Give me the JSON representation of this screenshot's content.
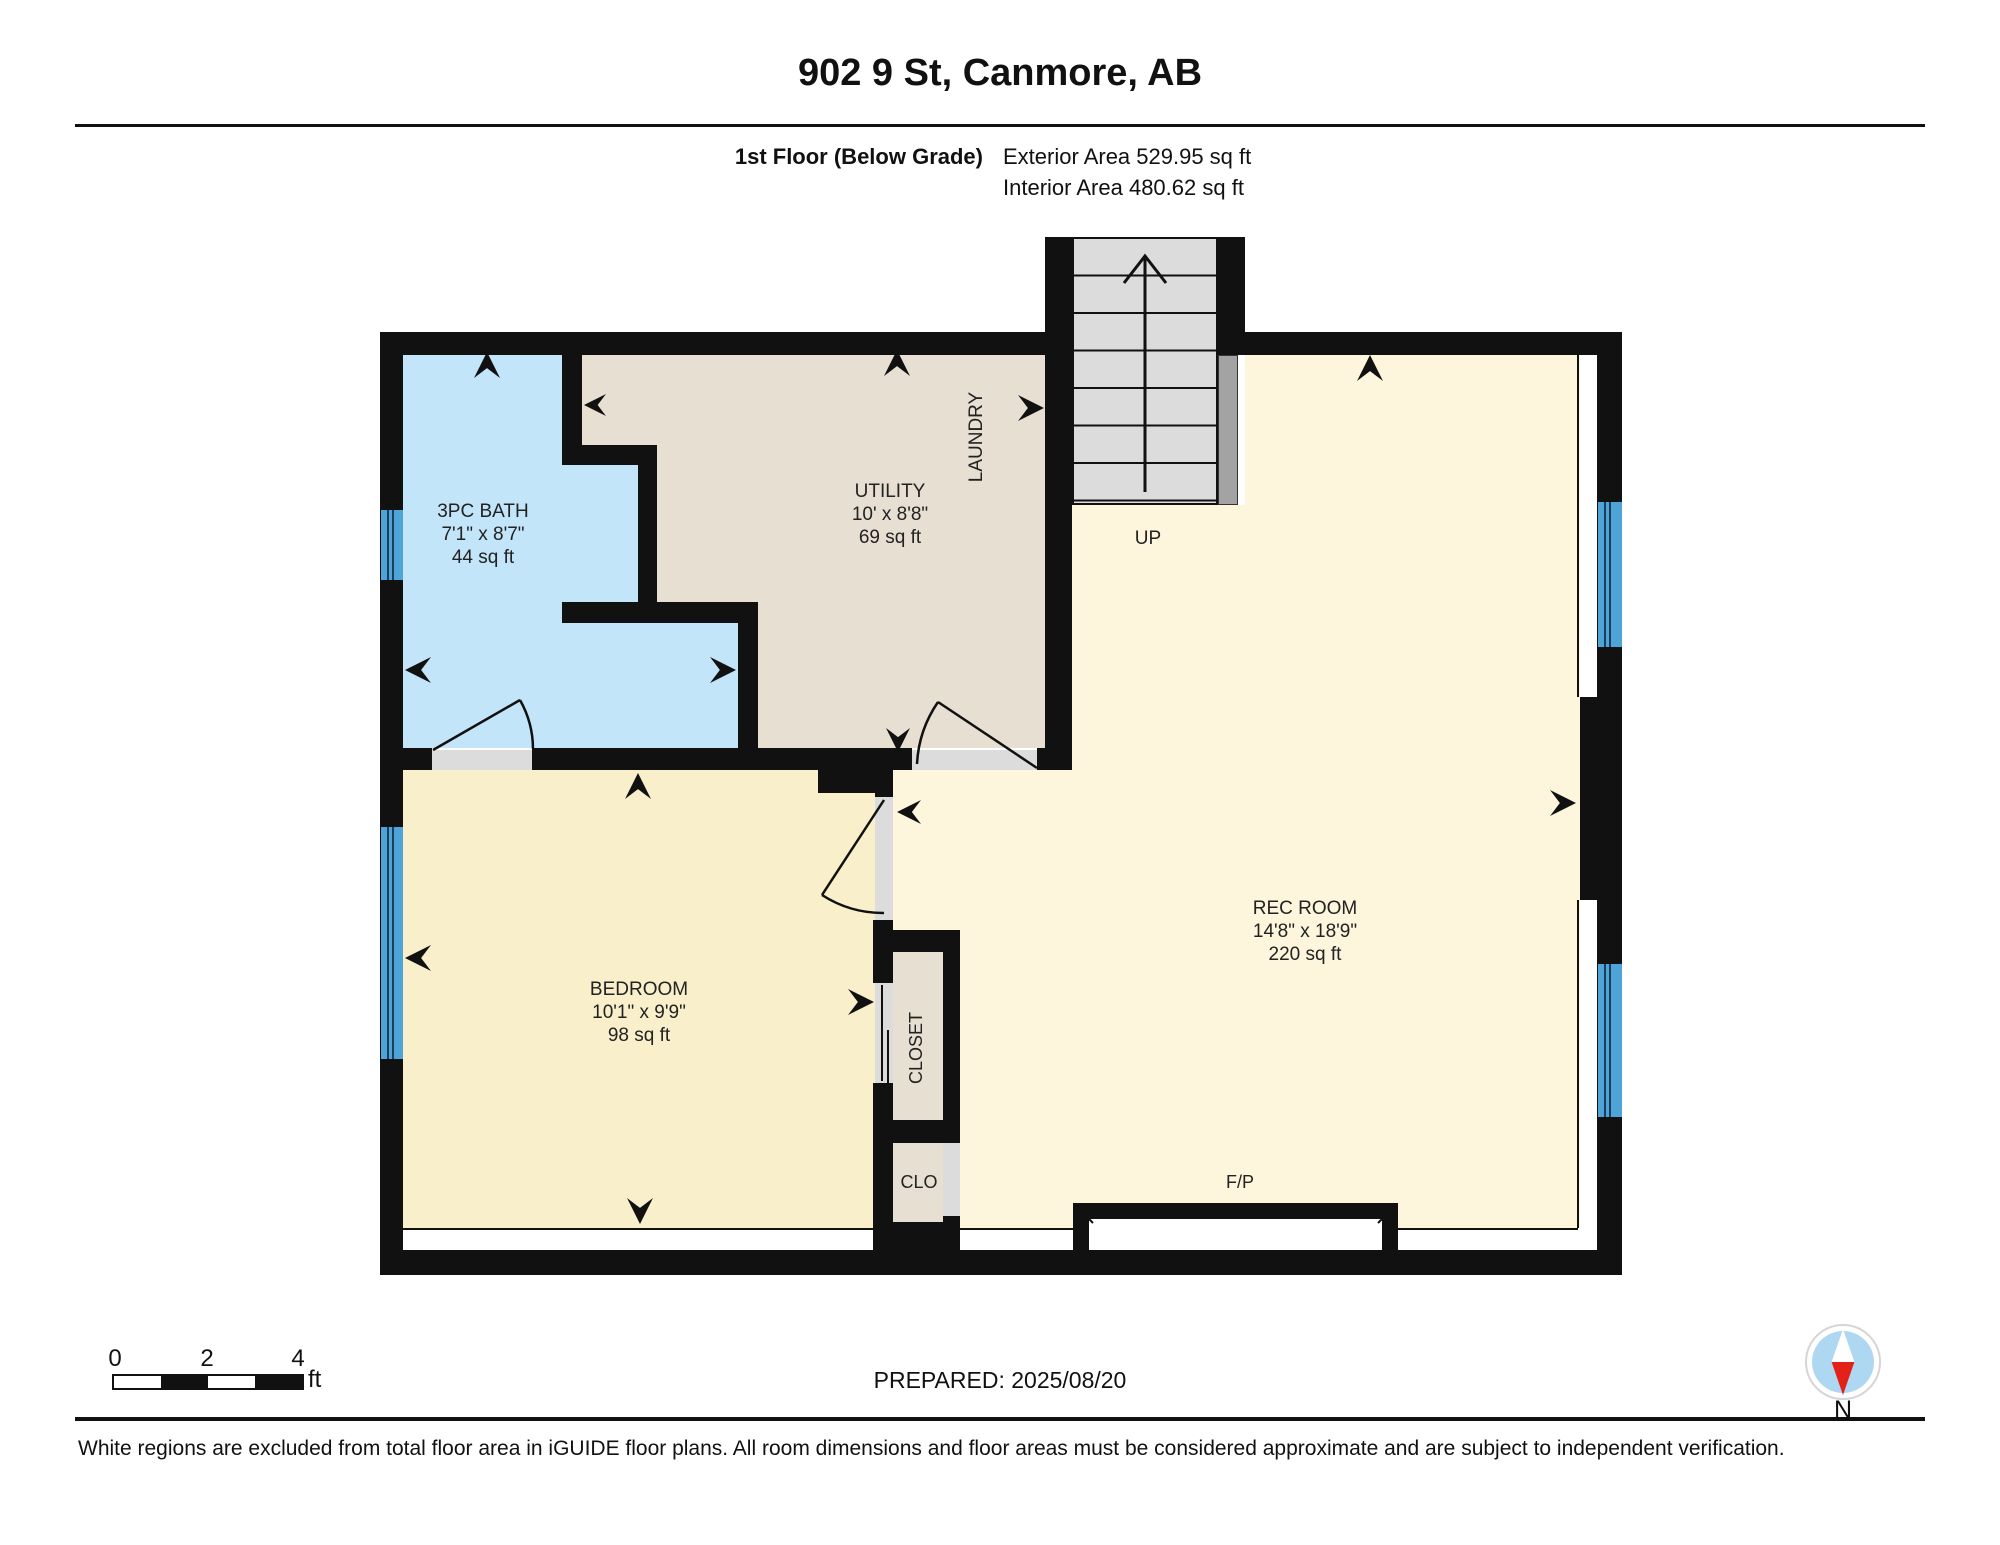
{
  "header": {
    "title": "902 9 St, Canmore, AB",
    "floor_label": "1st Floor (Below Grade)",
    "exterior_area": "Exterior Area 529.95 sq ft",
    "interior_area": "Interior Area 480.62 sq ft"
  },
  "rooms": {
    "bath": {
      "name": "3PC BATH",
      "dims": "7'1\" x 8'7\"",
      "area": "44 sq ft"
    },
    "utility": {
      "name": "UTILITY",
      "dims": "10' x 8'8\"",
      "area": "69 sq ft"
    },
    "laundry": {
      "label": "LAUNDRY"
    },
    "rec": {
      "name": "REC ROOM",
      "dims": "14'8\" x 18'9\"",
      "area": "220 sq ft"
    },
    "bedroom": {
      "name": "BEDROOM",
      "dims": "10'1\" x 9'9\"",
      "area": "98 sq ft"
    },
    "closet": {
      "label": "CLOSET"
    },
    "clo": {
      "label": "CLO"
    },
    "fireplace": {
      "label": "F/P"
    },
    "stairs": {
      "up_label": "UP"
    }
  },
  "footer": {
    "scale": {
      "tick0": "0",
      "tick2": "2",
      "tick4": "4",
      "unit": "ft"
    },
    "prepared": "PREPARED: 2025/08/20",
    "compass_label": "N",
    "disclaimer": "White regions are excluded from total floor area in iGUIDE floor plans. All room dimensions and floor areas must be considered approximate and are subject to independent verification."
  },
  "colors": {
    "wall": "#111111",
    "bath": "#c3e5f9",
    "utility": "#e6dfd2",
    "rec_room": "#fdf5dc",
    "bedroom": "#faefcb",
    "window_blue": "#4ea4d6",
    "stair_tread": "#dcdcdc",
    "compass_red": "#e32119"
  }
}
